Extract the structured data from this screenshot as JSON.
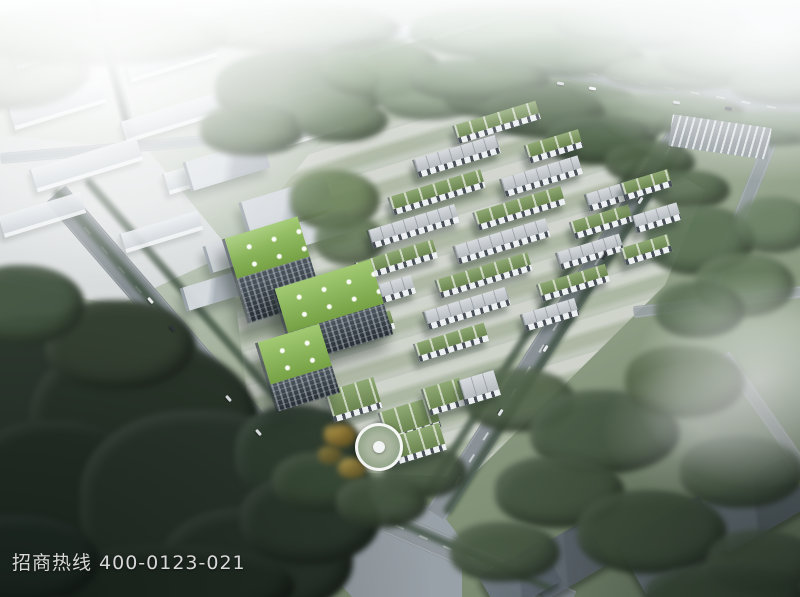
{
  "image": {
    "description": "Aerial architectural rendering of an eco industrial park with green-roofed factory buildings, a stepped office tower, tree-lined roads and a circular plaza",
    "hotline": {
      "text": "招商热线 400-0123-021"
    }
  },
  "colors": {
    "green_roof": "#7d9b5d",
    "vivid_green_roof": "#8abd50",
    "grey_roof": "#c6ccd1",
    "road_grey": "#8a9298",
    "dark_trees": "#2a352c",
    "haze_white": "#fbfcfc",
    "hotline_text": "#d8d8d8"
  },
  "scene": {
    "rotation_deg": -17,
    "campus_buildings": [
      [
        495,
        122,
        85,
        13,
        "green"
      ],
      [
        455,
        156,
        85,
        13,
        "grey"
      ],
      [
        552,
        146,
        55,
        13,
        "green"
      ],
      [
        435,
        192,
        95,
        13,
        "green"
      ],
      [
        540,
        176,
        80,
        13,
        "grey"
      ],
      [
        412,
        226,
        90,
        13,
        "grey"
      ],
      [
        518,
        208,
        90,
        13,
        "green"
      ],
      [
        612,
        195,
        55,
        12,
        "grey"
      ],
      [
        395,
        260,
        80,
        13,
        "green"
      ],
      [
        500,
        241,
        95,
        13,
        "grey"
      ],
      [
        600,
        222,
        60,
        12,
        "green"
      ],
      [
        378,
        294,
        70,
        13,
        "grey"
      ],
      [
        482,
        275,
        95,
        13,
        "green"
      ],
      [
        588,
        252,
        65,
        12,
        "grey"
      ],
      [
        362,
        328,
        60,
        13,
        "green"
      ],
      [
        465,
        308,
        85,
        13,
        "grey"
      ],
      [
        572,
        283,
        70,
        12,
        "green"
      ],
      [
        450,
        342,
        72,
        13,
        "green"
      ],
      [
        548,
        315,
        55,
        12,
        "grey"
      ],
      [
        645,
        185,
        48,
        12,
        "green"
      ],
      [
        655,
        218,
        46,
        12,
        "grey"
      ],
      [
        645,
        250,
        48,
        12,
        "green"
      ],
      [
        352,
        400,
        50,
        26,
        "green"
      ],
      [
        408,
        420,
        55,
        26,
        "green"
      ],
      [
        443,
        397,
        38,
        22,
        "green"
      ],
      [
        478,
        388,
        36,
        20,
        "grey"
      ],
      [
        416,
        444,
        52,
        22,
        "green"
      ]
    ],
    "context_buildings": [
      [
        60,
        45,
        100,
        18
      ],
      [
        170,
        60,
        90,
        16
      ],
      [
        55,
        105,
        95,
        20
      ],
      [
        170,
        118,
        100,
        18
      ],
      [
        280,
        92,
        80,
        16
      ],
      [
        85,
        165,
        110,
        20
      ],
      [
        205,
        172,
        85,
        18
      ],
      [
        40,
        215,
        85,
        18
      ],
      [
        160,
        232,
        80,
        16
      ],
      [
        320,
        55,
        75,
        14
      ],
      [
        395,
        38,
        85,
        14
      ],
      [
        465,
        22,
        75,
        12
      ],
      [
        310,
        130,
        60,
        14
      ],
      [
        255,
        25,
        70,
        14
      ]
    ],
    "massing_buildings": [
      [
        225,
        165,
        80,
        30
      ],
      [
        285,
        205,
        88,
        32
      ],
      [
        238,
        250,
        66,
        28
      ],
      [
        208,
        292,
        52,
        24
      ],
      [
        320,
        228,
        54,
        24
      ]
    ],
    "office_blocks": [
      [
        271,
        270,
        76,
        42,
        46
      ],
      [
        331,
        312,
        100,
        46,
        32
      ],
      [
        296,
        368,
        64,
        44,
        28
      ]
    ],
    "roads": [
      [
        652,
        85,
        310,
        20,
        10.5,
        "#9aa4a9",
        true,
        1
      ],
      [
        200,
        360,
        440,
        26,
        49,
        "#868e93",
        true,
        1
      ],
      [
        565,
        312,
        480,
        22,
        122.5,
        "#8a9298",
        true,
        1
      ],
      [
        480,
        562,
        200,
        24,
        23.5,
        "#8f979c",
        true,
        1
      ],
      [
        115,
        75,
        160,
        12,
        75,
        "#b7bec3",
        false,
        0.85
      ],
      [
        115,
        148,
        230,
        11,
        -5,
        "#b7bec3",
        false,
        0.85
      ],
      [
        745,
        205,
        210,
        14,
        112,
        "#9aa2a7",
        false,
        0.9
      ],
      [
        718,
        302,
        170,
        12,
        -7,
        "#9aa2a7",
        false,
        0.85
      ],
      [
        770,
        420,
        160,
        13,
        55,
        "#98a0a5",
        false,
        0.8
      ]
    ],
    "paths": [
      [
        80,
        525,
        140,
        10,
        30,
        "#777f85",
        0.5
      ],
      [
        180,
        510,
        190,
        9,
        32,
        "#777f85",
        0.45
      ],
      [
        262,
        490,
        170,
        8,
        35,
        "#777f85",
        0.4
      ],
      [
        165,
        437,
        46,
        36,
        -15,
        "#9aa0a4",
        0.75
      ]
    ],
    "roadside_strips": [
      [
        196,
        352,
        430,
        9,
        49
      ],
      [
        224,
        338,
        420,
        8,
        49
      ],
      [
        572,
        315,
        470,
        9,
        122.5
      ],
      [
        549,
        300,
        460,
        8,
        122.5
      ],
      [
        650,
        109,
        300,
        8,
        10.5
      ],
      [
        470,
        553,
        180,
        7,
        23.5
      ],
      [
        112,
        68,
        150,
        6,
        75
      ]
    ],
    "dark_roofs": [
      [
        755,
        505,
        95,
        55,
        -30,
        "#707a86"
      ],
      [
        672,
        545,
        95,
        60,
        -30,
        "#6b7580"
      ],
      [
        565,
        560,
        75,
        50,
        -30,
        "#67707b"
      ],
      [
        520,
        578,
        70,
        45,
        -30,
        "#6d7681"
      ]
    ],
    "dark_slabs": [
      [
        28,
        362,
        62,
        16,
        20
      ],
      [
        22,
        425,
        70,
        18,
        22
      ],
      [
        38,
        485,
        60,
        16,
        24
      ]
    ],
    "trees": [
      [
        45,
        385,
        95,
        70,
        "#2c372e",
        1
      ],
      [
        145,
        425,
        115,
        85,
        "#293429",
        1
      ],
      [
        60,
        505,
        105,
        85,
        "#252f27",
        1
      ],
      [
        205,
        505,
        125,
        95,
        "#2a352c",
        1
      ],
      [
        120,
        345,
        75,
        45,
        "#333f31",
        1
      ],
      [
        258,
        562,
        95,
        55,
        "#28332a",
        1
      ],
      [
        300,
        455,
        65,
        50,
        "#2f3d30",
        1
      ],
      [
        175,
        585,
        120,
        40,
        "#222c24",
        1
      ],
      [
        20,
        560,
        80,
        45,
        "#243029",
        1
      ],
      [
        310,
        520,
        70,
        45,
        "#2b372c",
        1
      ],
      [
        25,
        305,
        60,
        40,
        "#41523f",
        0.95
      ],
      [
        300,
        90,
        85,
        40,
        "#6d8366",
        0.95
      ],
      [
        380,
        68,
        60,
        30,
        "#78906e",
        0.9
      ],
      [
        252,
        130,
        52,
        26,
        "#5e7456",
        0.95
      ],
      [
        342,
        120,
        46,
        22,
        "#687e5f",
        0.9
      ],
      [
        430,
        95,
        55,
        25,
        "#71896a",
        0.85
      ],
      [
        100,
        35,
        130,
        30,
        "#9aad96",
        0.8
      ],
      [
        300,
        28,
        100,
        25,
        "#a2b49e",
        0.75
      ],
      [
        520,
        32,
        110,
        28,
        "#93ac8e",
        0.8
      ],
      [
        650,
        22,
        95,
        28,
        "#a0b6a1",
        0.75
      ],
      [
        760,
        38,
        75,
        25,
        "#a8bba8",
        0.7
      ],
      [
        0,
        70,
        90,
        40,
        "#a3b4a0",
        0.6
      ],
      [
        560,
        58,
        85,
        20,
        "#80987b",
        0.9
      ],
      [
        680,
        73,
        75,
        18,
        "#879e82",
        0.85
      ],
      [
        740,
        60,
        80,
        22,
        "#8ca188",
        0.8
      ],
      [
        540,
        100,
        95,
        22,
        "#5f7759",
        0.95
      ],
      [
        660,
        113,
        85,
        20,
        "#667e5f",
        0.9
      ],
      [
        770,
        128,
        65,
        18,
        "#6d8568",
        0.85
      ],
      [
        480,
        80,
        70,
        22,
        "#748c6e",
        0.9
      ],
      [
        790,
        85,
        60,
        20,
        "#7f9680",
        0.8
      ],
      [
        545,
        112,
        60,
        26,
        "#54694e",
        0.95
      ],
      [
        600,
        140,
        55,
        25,
        "#4e6349",
        0.95
      ],
      [
        650,
        162,
        45,
        22,
        "#52664b",
        0.9
      ],
      [
        690,
        190,
        40,
        20,
        "#566b50",
        0.85
      ],
      [
        700,
        240,
        55,
        35,
        "#5a7054",
        0.9
      ],
      [
        745,
        285,
        50,
        32,
        "#61775a",
        0.85
      ],
      [
        700,
        310,
        45,
        28,
        "#566b50",
        0.85
      ],
      [
        775,
        225,
        40,
        28,
        "#677d62",
        0.8
      ],
      [
        335,
        200,
        45,
        30,
        "#6a8258",
        0.85
      ],
      [
        350,
        240,
        35,
        25,
        "#5d7350",
        0.8
      ],
      [
        520,
        400,
        55,
        32,
        "#4f6148",
        0.9
      ],
      [
        605,
        432,
        75,
        42,
        "#475943",
        0.92
      ],
      [
        685,
        382,
        60,
        36,
        "#516346",
        0.88
      ],
      [
        560,
        492,
        65,
        36,
        "#42533e",
        0.92
      ],
      [
        652,
        532,
        75,
        42,
        "#3f503b",
        0.92
      ],
      [
        742,
        472,
        62,
        36,
        "#4a5c45",
        0.88
      ],
      [
        505,
        552,
        55,
        30,
        "#44553f",
        0.9
      ],
      [
        762,
        562,
        55,
        32,
        "#475843",
        0.85
      ],
      [
        725,
        595,
        80,
        30,
        "#3c4d3a",
        0.9
      ],
      [
        322,
        482,
        50,
        30,
        "#3a4b38",
        0.95
      ],
      [
        425,
        472,
        42,
        26,
        "#465741",
        0.9
      ],
      [
        382,
        502,
        46,
        26,
        "#40513c",
        0.92
      ],
      [
        340,
        435,
        16,
        12,
        "#bd9a3e",
        0.9
      ],
      [
        352,
        468,
        14,
        10,
        "#c2a244",
        0.85
      ],
      [
        330,
        455,
        12,
        9,
        "#a88f3a",
        0.8
      ]
    ],
    "cars": [
      [
        150,
        300,
        49,
        "#e8eaec"
      ],
      [
        172,
        328,
        49,
        "#30353a"
      ],
      [
        228,
        398,
        49,
        "#dde1e4"
      ],
      [
        258,
        432,
        49,
        "#e8eaec"
      ],
      [
        640,
        200,
        122,
        "#dde1e4"
      ],
      [
        604,
        256,
        122,
        "#33383d"
      ],
      [
        545,
        348,
        122,
        "#e6e9eb"
      ],
      [
        500,
        412,
        122,
        "#dfe3e6"
      ],
      [
        592,
        88,
        10,
        "#f0f2f4"
      ],
      [
        676,
        102,
        10,
        "#caced2"
      ],
      [
        728,
        108,
        10,
        "#2f343a"
      ],
      [
        560,
        83,
        10,
        "#d7dbde"
      ]
    ]
  }
}
